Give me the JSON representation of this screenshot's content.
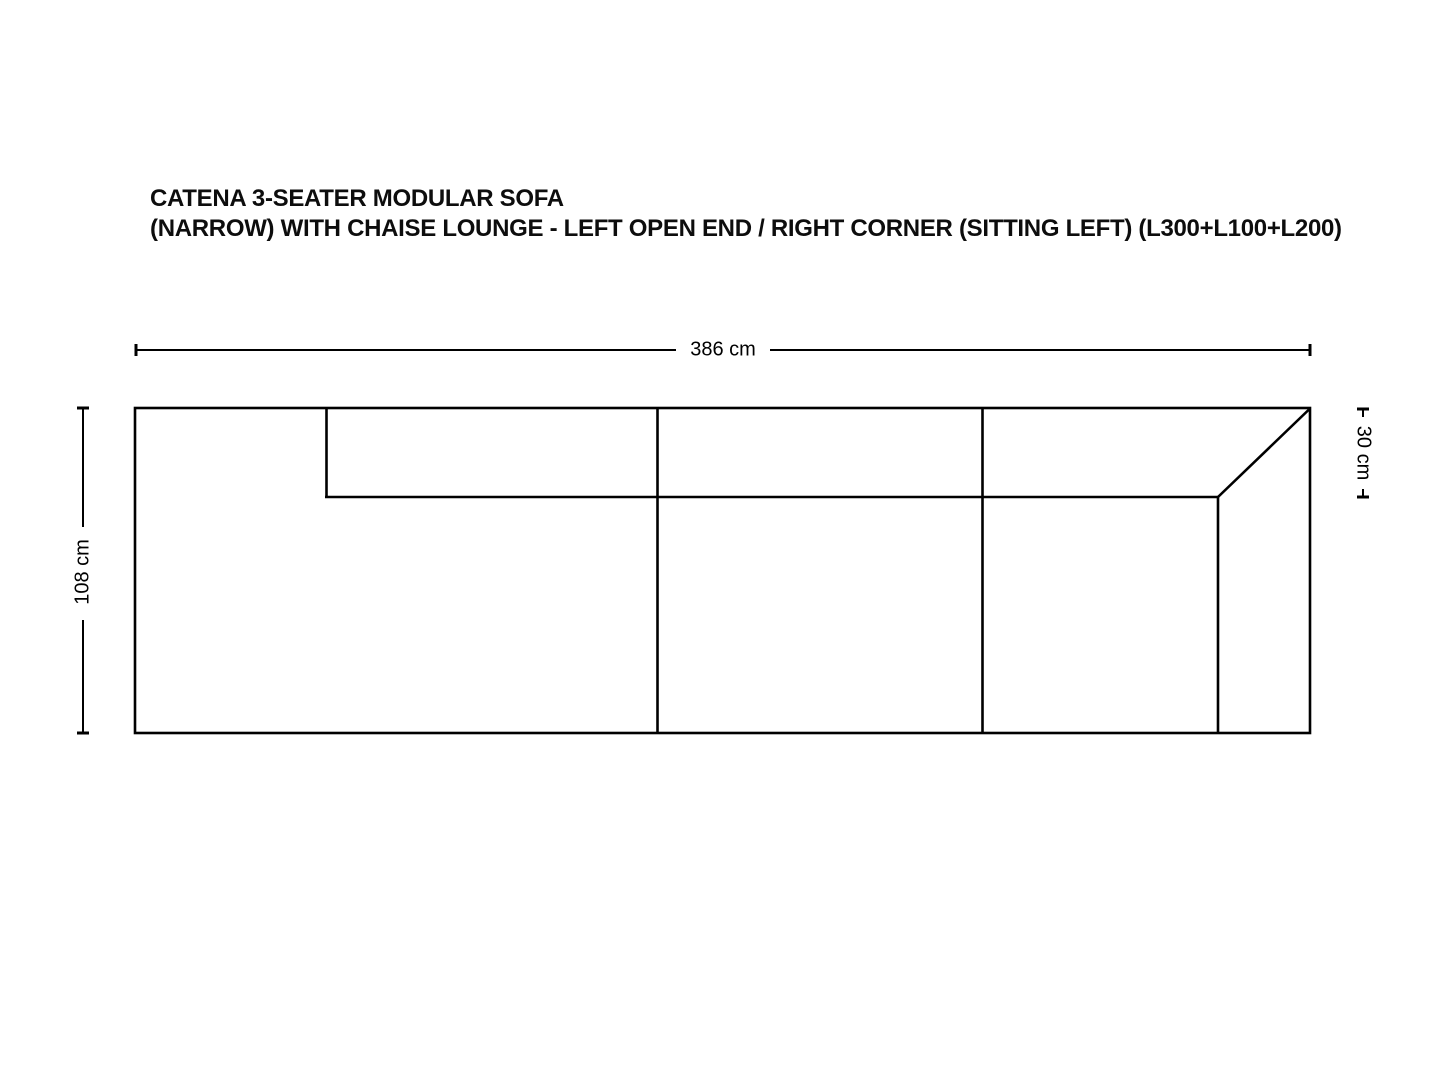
{
  "page": {
    "background_color": "#ffffff",
    "line_color": "#000000",
    "text_color": "#0d0d0d"
  },
  "title": {
    "line1": "CATENA 3-SEATER MODULAR SOFA",
    "line2": "(NARROW) WITH CHAISE LOUNGE - LEFT OPEN END / RIGHT CORNER (SITTING LEFT) (L300+L100+L200)"
  },
  "dimensions": {
    "overall_width": {
      "label": "386 cm",
      "value": 386,
      "unit": "cm"
    },
    "overall_depth": {
      "label": "108 cm",
      "value": 108,
      "unit": "cm"
    },
    "backrest_depth": {
      "label": "30 cm",
      "value": 30,
      "unit": "cm"
    }
  }
}
